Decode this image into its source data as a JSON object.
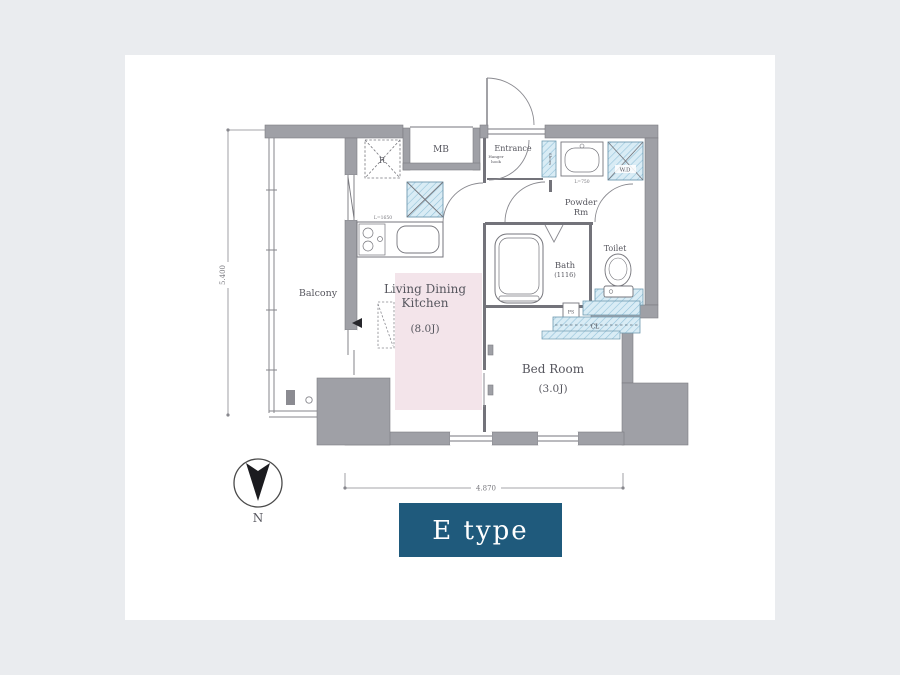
{
  "colors": {
    "page_bg": "#eaecef",
    "card_bg": "#ffffff",
    "wall": "#9fa0a6",
    "hatch_fill": "#d9ecf5",
    "hatch_line": "#93c2d9",
    "ldk_fill": "#f3e4ea",
    "line": "#76767c",
    "text": "#56565e",
    "accent_box": "#1f5a7c",
    "accent_text": "#ffffff"
  },
  "plan": {
    "rooms": {
      "balcony": {
        "label": "Balcony"
      },
      "living_dining_kitchen": {
        "label_line1": "Living Dining",
        "label_line2": "Kitchen",
        "size": "(8.0J)"
      },
      "bed_room": {
        "label": "Bed Room",
        "size": "(3.0J)"
      },
      "bath": {
        "label": "Bath",
        "size": "(1116)"
      },
      "powder_room": {
        "label_line1": "Powder",
        "label_line2": "Rm"
      },
      "toilet": {
        "label": "Toilet"
      },
      "entrance": {
        "label": "Entrance",
        "note_line1": "Hanger",
        "note_line2": "hook"
      }
    },
    "fixtures": {
      "meter_box": "MB",
      "refrigerator": "R",
      "washer_dryer": "W.D",
      "closet": "CL",
      "pipe_space": "PS",
      "shoes_box": "Shoes",
      "washbasin_length": "L=750",
      "kitchen_length": "L=1650"
    },
    "dimensions": {
      "vertical": "5.400",
      "horizontal": "4.870"
    },
    "compass": {
      "label": "N"
    },
    "unit_type": {
      "label": "E type"
    }
  }
}
